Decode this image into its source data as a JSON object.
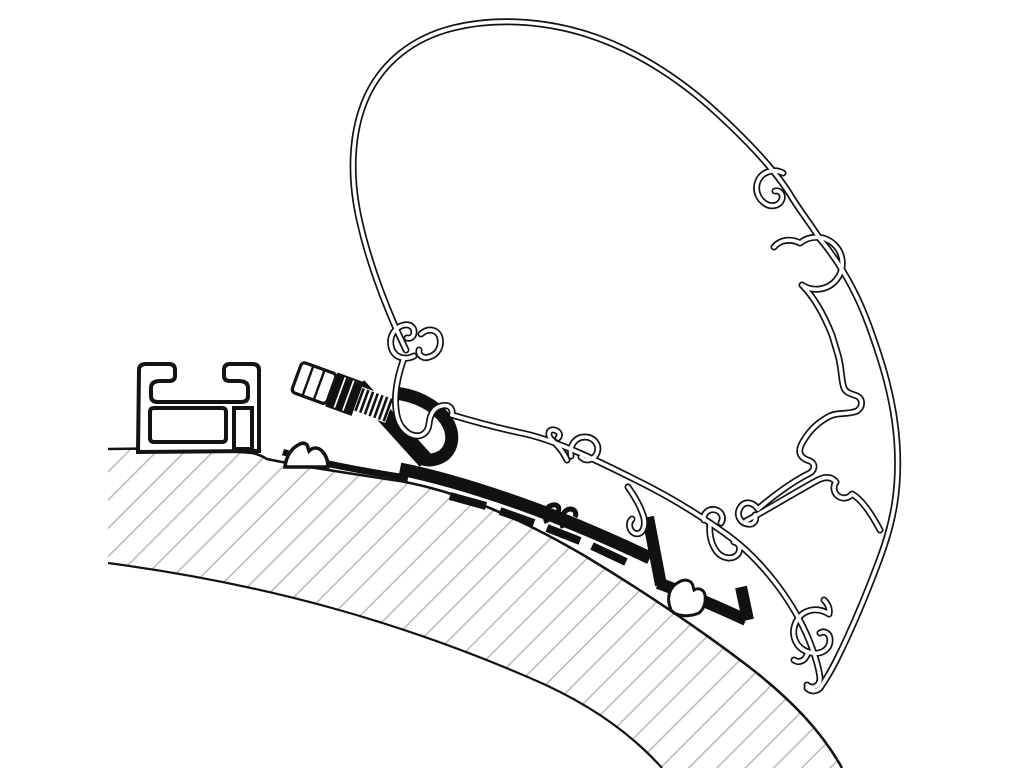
{
  "figure": {
    "title": "Awning adapter cross-section technical drawing",
    "description": "Black-and-white line-art cross-section: a hollow awning cassette profile attached to a curved, hatched caravan roof by a solid black adapter rail, a hex fixing bolt with washers and threaded shaft, and a separate roof mounting rail bracket on the left.",
    "type": "technical-illustration",
    "text_content": ""
  },
  "colors": {
    "bg": "#ffffff",
    "line": "#131313",
    "fill": "#111111",
    "hatch": "#b7b7b7"
  },
  "parts": [
    {
      "id": "caravan-roof",
      "label": "Caravan roof (hatched cross-section band)"
    },
    {
      "id": "roof-mounting-rail",
      "label": "Roof mounting rail bracket (left)"
    },
    {
      "id": "rubber-foot",
      "label": "Rubber foot pad under adapter"
    },
    {
      "id": "fixing-bolt",
      "label": "Hex fixing bolt with washer stack and thread"
    },
    {
      "id": "adapter-profile",
      "label": "Adapter rail profile (solid black)"
    },
    {
      "id": "awning-cassette-profile",
      "label": "Awning cassette hollow extrusion profile"
    }
  ]
}
